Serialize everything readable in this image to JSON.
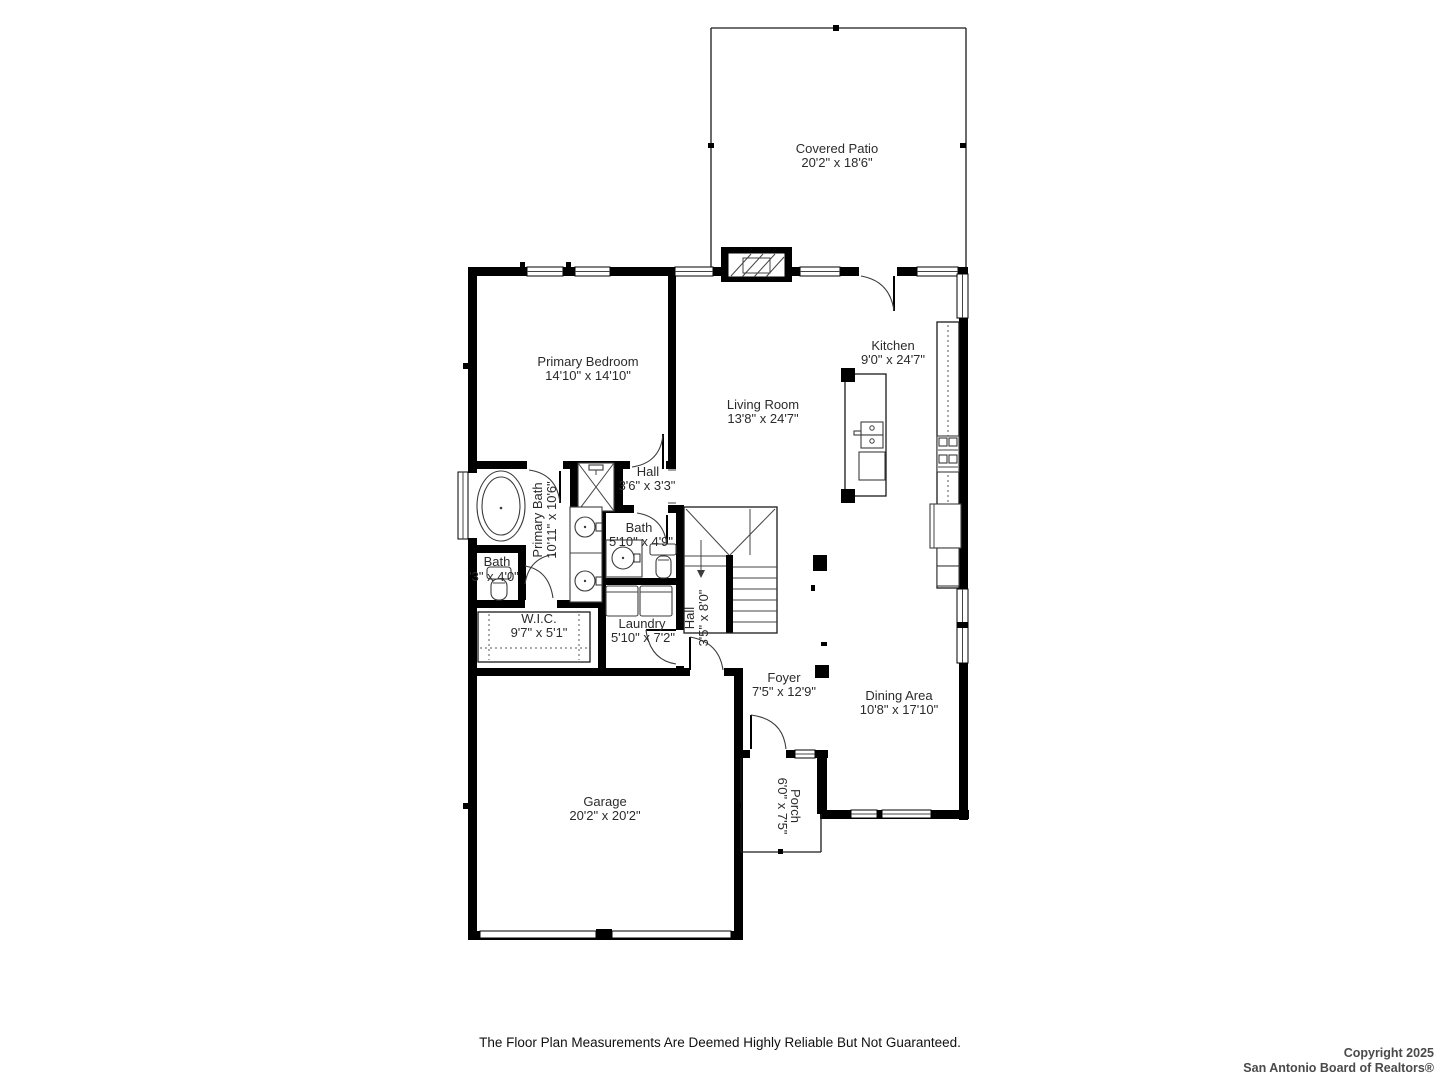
{
  "rooms": {
    "covered_patio": {
      "name": "Covered Patio",
      "dims": "20'2\" x 18'6\""
    },
    "primary_bedroom": {
      "name": "Primary Bedroom",
      "dims": "14'10\" x 14'10\""
    },
    "kitchen": {
      "name": "Kitchen",
      "dims": "9'0\" x 24'7\""
    },
    "living_room": {
      "name": "Living Room",
      "dims": "13'8\" x 24'7\""
    },
    "hall_upper": {
      "name": "Hall",
      "dims": "3'6\" x 3'3\""
    },
    "primary_bath": {
      "name": "Primary Bath",
      "dims": "10'11\" x 10'6\""
    },
    "bath_small": {
      "name": "Bath",
      "dims": "'3\" x 4'0\""
    },
    "bath": {
      "name": "Bath",
      "dims": "5'10\" x 4'9\""
    },
    "wic": {
      "name": "W.I.C.",
      "dims": "9'7\" x 5'1\""
    },
    "laundry": {
      "name": "Laundry",
      "dims": "5'10\" x 7'2\""
    },
    "hall_lower": {
      "name": "Hall",
      "dims": "3'5\" x 8'0\""
    },
    "foyer": {
      "name": "Foyer",
      "dims": "7'5\" x 12'9\""
    },
    "dining": {
      "name": "Dining Area",
      "dims": "10'8\" x 17'10\""
    },
    "garage": {
      "name": "Garage",
      "dims": "20'2\" x 20'2\""
    },
    "porch": {
      "name": "Porch",
      "dims": "6'0\" x 7'5\""
    }
  },
  "footer": {
    "disclaimer": "The Floor Plan Measurements Are Deemed Highly Reliable But Not Guaranteed.",
    "copyright_line1": "Copyright 2025",
    "copyright_line2": "San Antonio Board of Realtors®"
  },
  "colors": {
    "wall": "#000000",
    "background": "#ffffff",
    "label_text": "#2b2b2b"
  }
}
